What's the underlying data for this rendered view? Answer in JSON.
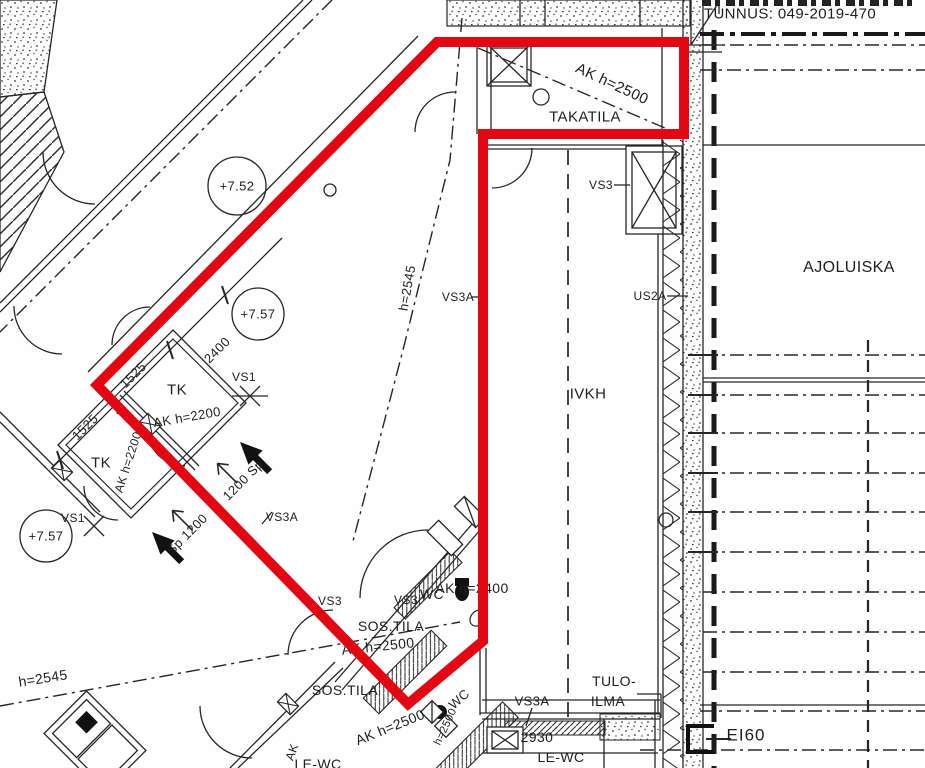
{
  "header": {
    "tunnus": "TUNNUS: 049-2019-470"
  },
  "rooms": {
    "takatila": "TAKATILA",
    "ivkh": "IVKH",
    "ajoluiska": "AJOLUISKA",
    "sos_tila_1": "SOS.TILA",
    "sos_tila_2": "SOS.TILA",
    "tk_1": "TK",
    "tk_2": "TK",
    "wc_1": "WC",
    "wc_2": "WC",
    "le_wc_1": "LE-WC",
    "le_wc_2": "LE-WC",
    "tulo_ilma_line1": "TULO-",
    "tulo_ilma_line2": "ILMA"
  },
  "wall_types": {
    "vs3_shaft": "VS3",
    "vs3_1": "VS3",
    "vs3_2": "VS3",
    "vs3a_1": "VS3A",
    "vs3a_2": "VS3A",
    "vs3a_3": "VS3A",
    "us2a": "US2A",
    "vs1_1": "VS1",
    "vs1_2": "VS1",
    "ei60": "EI60"
  },
  "heights": {
    "ak_takatila": "AK h=2500",
    "ak_tk": "AK h=2200",
    "ak_tk_vert": "AK h=2200",
    "ak_wc": "AK h=2400",
    "ak_sos_1": "AK h=2500",
    "ak_sos_2": "AK h=2500",
    "h_mid": "h=2545",
    "h_bottom": "h=2545",
    "h_wc": "h=2500",
    "ak_fragment": "AK"
  },
  "levels": {
    "l1": "+7.52",
    "l2": "+7.57",
    "l3": "+7.57"
  },
  "dimensions": {
    "d2400": "2400",
    "d1525_1": "1525",
    "d1525_2": "1525",
    "d2930": "2930",
    "sp_1": "1200 Sp",
    "sp_2": "Sp 1200"
  },
  "colors": {
    "highlight": "#e30613",
    "line": "#262626"
  }
}
